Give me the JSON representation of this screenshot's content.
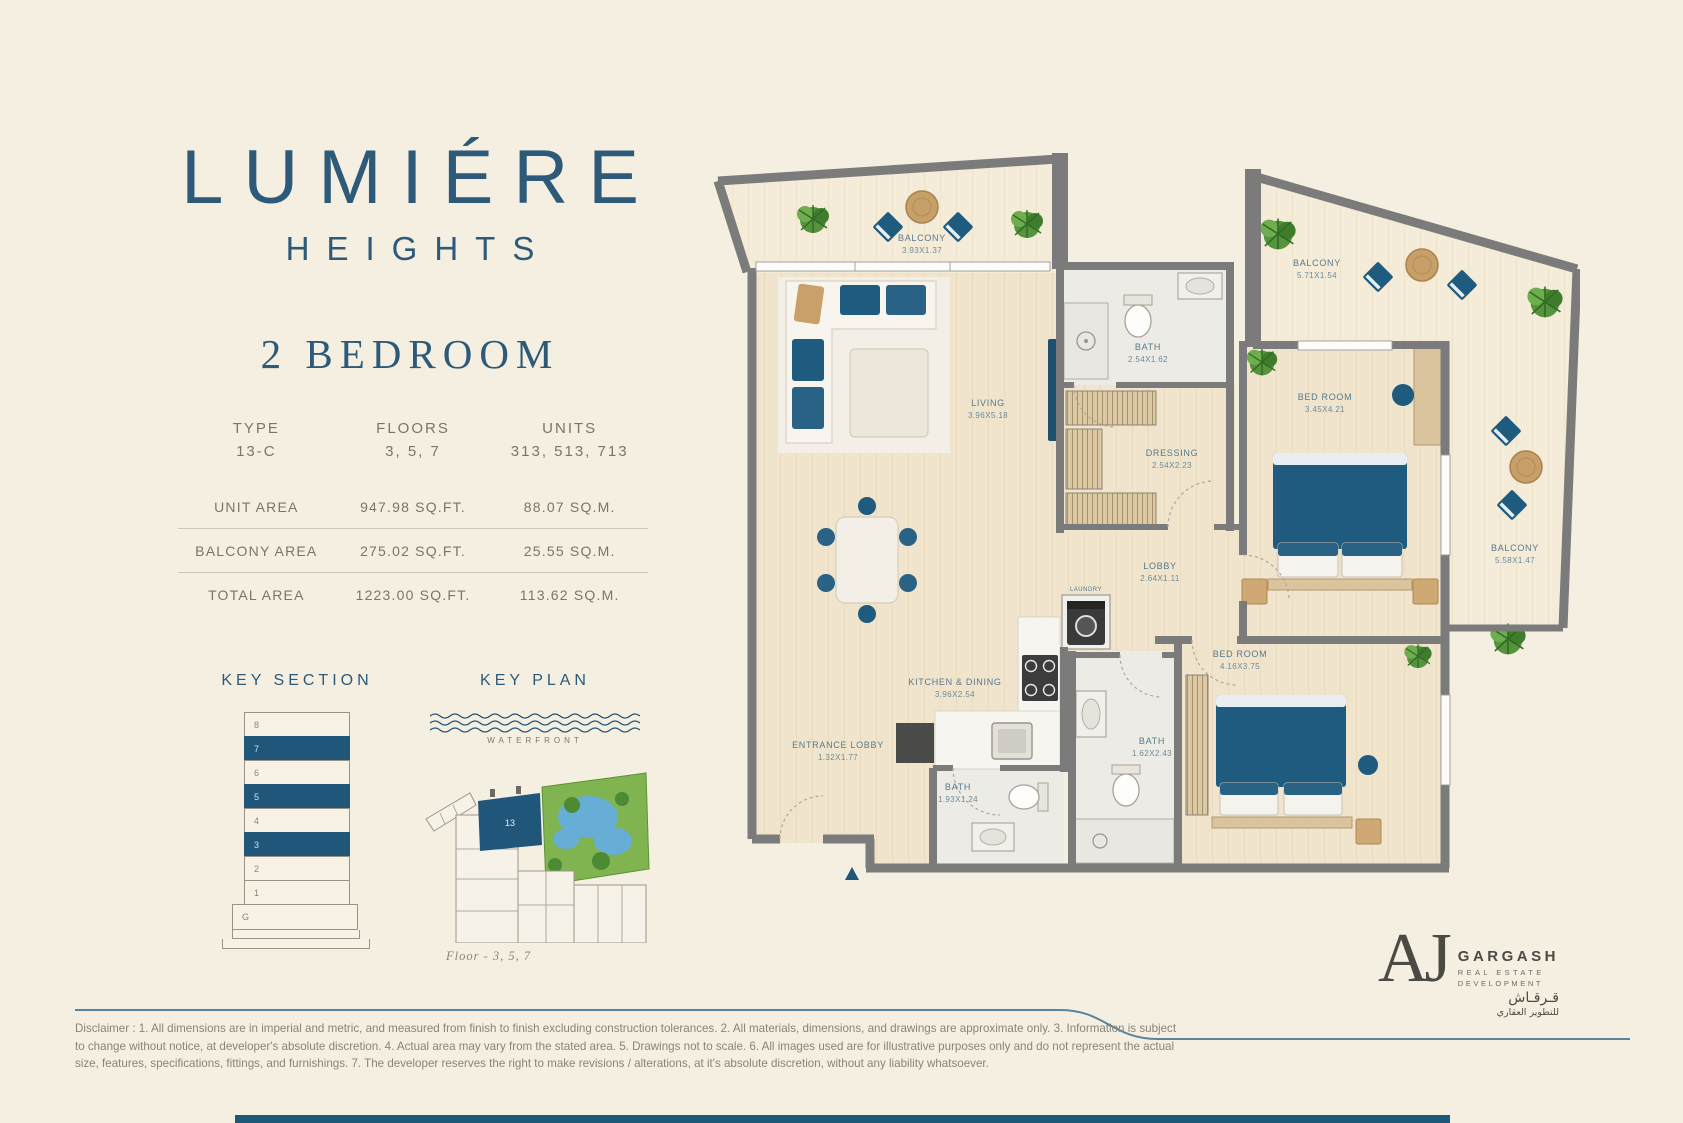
{
  "brand": {
    "title": "LUMIÉRE",
    "subtitle": "HEIGHTS",
    "unit_heading": "2 BEDROOM"
  },
  "spec_table": {
    "headers": [
      {
        "label": "TYPE",
        "value": "13-C"
      },
      {
        "label": "FLOORS",
        "value": "3, 5, 7"
      },
      {
        "label": "UNITS",
        "value": "313, 513, 713"
      }
    ],
    "rows": [
      {
        "label": "UNIT AREA",
        "imperial": "947.98 SQ.FT.",
        "metric": "88.07 SQ.M."
      },
      {
        "label": "BALCONY AREA",
        "imperial": "275.02 SQ.FT.",
        "metric": "25.55 SQ.M."
      },
      {
        "label": "TOTAL AREA",
        "imperial": "1223.00 SQ.FT.",
        "metric": "113.62 SQ.M."
      }
    ]
  },
  "key_section": {
    "title": "KEY SECTION",
    "floors": [
      "8",
      "7",
      "6",
      "5",
      "4",
      "3",
      "2",
      "1",
      "G"
    ],
    "highlighted_floors": [
      "7",
      "5",
      "3"
    ]
  },
  "key_plan": {
    "title": "KEY PLAN",
    "waterfront_label": "WATERFRONT",
    "unit_label": "13",
    "caption": "Floor - 3, 5, 7"
  },
  "floor_plan": {
    "rooms": [
      {
        "name": "BALCONY",
        "dims": "3.93X1.37"
      },
      {
        "name": "BALCONY",
        "dims": "5.71X1.54"
      },
      {
        "name": "BALCONY",
        "dims": "5.58X1.47"
      },
      {
        "name": "LIVING",
        "dims": "3.96X5.18"
      },
      {
        "name": "BATH",
        "dims": "2.54X1.62"
      },
      {
        "name": "DRESSING",
        "dims": "2.54X2.23"
      },
      {
        "name": "BED ROOM",
        "dims": "3.45X4.21"
      },
      {
        "name": "LOBBY",
        "dims": "2.64X1.11"
      },
      {
        "name": "LAUNDRY",
        "dims": ""
      },
      {
        "name": "KITCHEN & DINING",
        "dims": "3.96X2.54"
      },
      {
        "name": "ENTRANCE LOBBY",
        "dims": "1.32X1.77"
      },
      {
        "name": "BATH",
        "dims": "1.93X1.24"
      },
      {
        "name": "BATH",
        "dims": "1.62X2.43"
      },
      {
        "name": "BED ROOM",
        "dims": "4.16X3.75"
      }
    ],
    "entrance_label": "ENTRANCE"
  },
  "footer": {
    "disclaimer": "Disclaimer : 1. All dimensions are in imperial and metric, and measured from finish to finish excluding construction tolerances. 2. All materials, dimensions, and drawings are approximate only. 3. Information is subject to change without notice, at developer's absolute discretion. 4. Actual area may vary from the stated area. 5. Drawings not to scale. 6. All images used are for illustrative purposes only and do not represent the actual size, features, specifications, fittings, and furnishings. 7. The developer reserves the right to make revisions / alterations, at it's absolute discretion, without any liability whatsoever.",
    "logo": {
      "monogram": "AJ",
      "name": "GARGASH",
      "line1": "REAL ESTATE",
      "line2": "DEVELOPMENT",
      "arabic_name": "قـرقـاش",
      "arabic_sub": "للتطوير العقاري"
    }
  },
  "colors": {
    "accent_navy": "#1f567a",
    "background_cream": "#f5efe2",
    "wall_gray": "#7b7b7b",
    "wood_floor": "#f0e4cd",
    "bath_floor": "#edebe5",
    "plant_green": "#55933d",
    "table_tan": "#c9a06a"
  }
}
